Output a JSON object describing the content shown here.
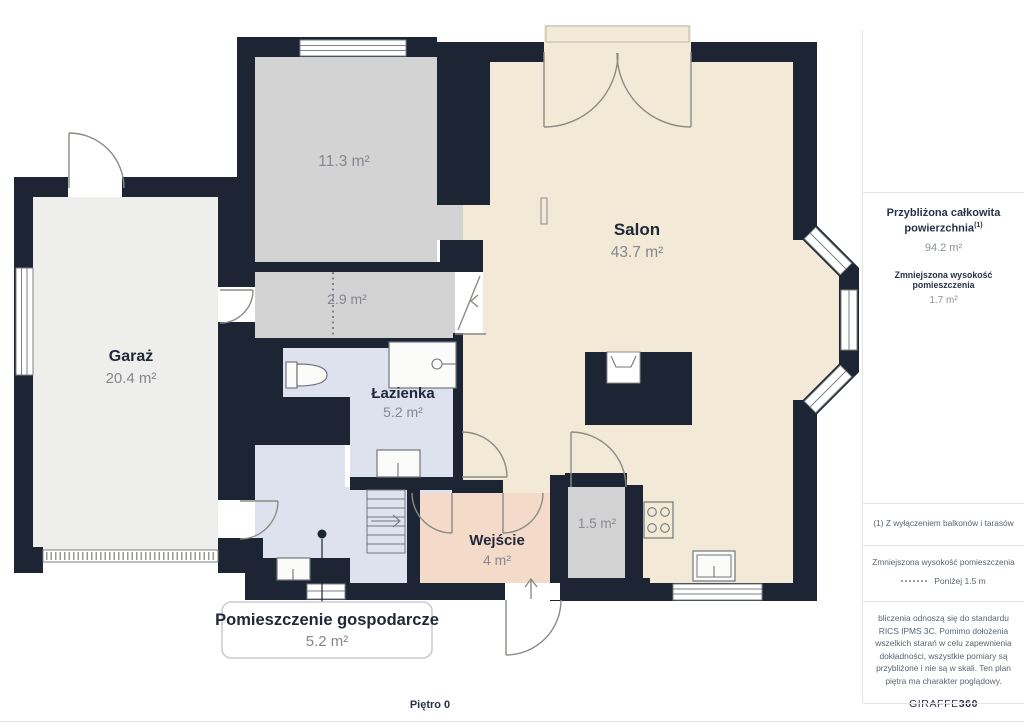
{
  "page": {
    "floor_label": "Piętro 0"
  },
  "plan": {
    "rooms": {
      "bedroom": {
        "area": "11.3 m²"
      },
      "garage": {
        "name": "Garaż",
        "area": "20.4 m²"
      },
      "hall": {
        "area": "2.9 m²"
      },
      "bathroom": {
        "name": "Łazienka",
        "area": "5.2 m²"
      },
      "living_room": {
        "name": "Salon",
        "area": "43.7 m²"
      },
      "entrance": {
        "name": "Wejście",
        "area": "4 m²"
      },
      "closet": {
        "area": "1.5 m²"
      },
      "utility_room": {
        "name": "Pomieszczenie gospodarcze",
        "area": "5.2 m²"
      }
    }
  },
  "sidebar": {
    "total_area": {
      "title": "Przybliżona całkowita powierzchnia",
      "superscript": "(1)",
      "value": "94.2 m²"
    },
    "reduced_height": {
      "title": "Zmniejszona wysokość pomieszczenia",
      "value": "1.7 m²"
    },
    "footnote": "(1) Z wyłączeniem balkonów i tarasów",
    "legend": {
      "title": "Zmniejszona wysokość pomieszczenia",
      "value": "Poniżej 1.5 m"
    },
    "disclaimer": "bliczenia odnoszą się do standardu RICS IPMS 3C. Pomimo dołożenia wszelkich starań w celu zapewnienia dokładności, wszystkie pomiary są przybliżone i nie są w skali. Ten plan piętra ma charakter poglądowy.",
    "brand": {
      "regular": "GIRAFFE",
      "bold": "360"
    }
  },
  "colors": {
    "wall": "#1d2433",
    "living_room": "#f2e9d6",
    "gray_room": "#d3d3d4",
    "garage": "#eeeeec",
    "wet_room": "#dde2ee",
    "entrance": "#f4dbc9",
    "room_name_text": "#20283a",
    "area_text": "#84878e"
  }
}
